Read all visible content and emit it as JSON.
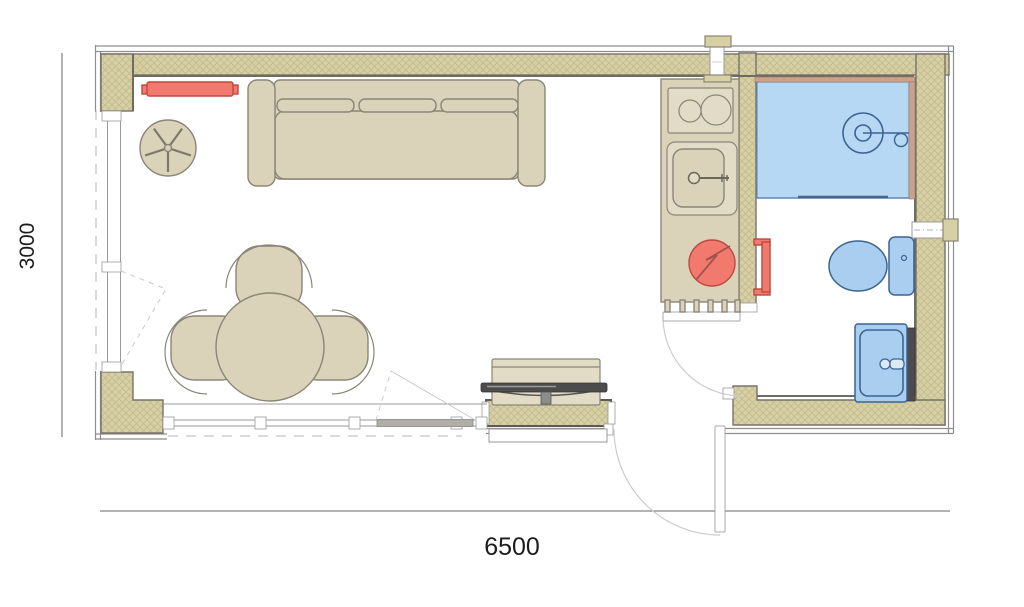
{
  "figure": {
    "type": "architectural-floor-plan"
  },
  "dimension_labels": {
    "width": "6500",
    "depth": "3000"
  },
  "colors": {
    "background": "#ffffff",
    "wall_fill": "#d7d0a5",
    "wall_hatch_line": "#c3ba8e",
    "wall_outline": "#76736a",
    "furniture_fill": "#dad3ba",
    "furniture_fill_light": "#e2dcc7",
    "furniture_outline": "#8a8577",
    "accent_red_fill": "#f2796d",
    "accent_red_outline": "#bb4a3f",
    "fixture_blue_fill": "#a9cef0",
    "fixture_blue_outline": "#3c6490",
    "shower_floor": "#b7d8f4",
    "shower_trim": "#c9a18c",
    "tv_dark": "#4c4c4c",
    "dimension_line": "#666666",
    "dimension_text": "#1c1c1c",
    "door_arc": "#cccccc",
    "frame_line": "#999999"
  },
  "fixtures": [
    "wall-radiator",
    "swivel-chair",
    "sofa",
    "dining-table",
    "dining-chair-top",
    "dining-chair-left",
    "dining-chair-right",
    "tv-cabinet",
    "tv",
    "cooktop",
    "kitchen-sink",
    "water-heater",
    "flue-vent",
    "bathroom-door",
    "entry-door",
    "shower",
    "shower-mixer",
    "towel-radiator",
    "toilet",
    "washbasin",
    "wall-sleeve",
    "window-left",
    "window-bottom"
  ]
}
